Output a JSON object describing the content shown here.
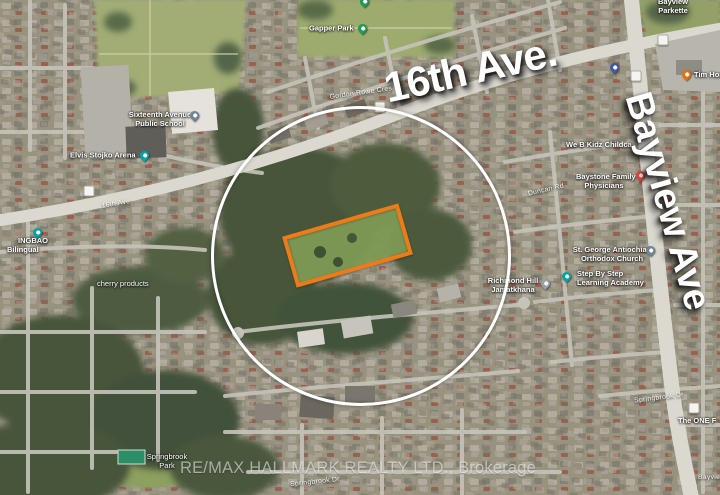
{
  "overlays": {
    "street_label_top": "16th Ave.",
    "street_label_right": "Bayview Ave",
    "watermark": "RE/MAX HALLMARK REALTY LTD., Brokerage",
    "highlight_circle_color": "#ffffff",
    "highlight_rect_color": "#ee7a18"
  },
  "places": [
    {
      "name": "gapper-park",
      "text": "Gapper Park",
      "pin_color": "#1c9c55"
    },
    {
      "name": "bayview-parkette",
      "line1": "Bayview",
      "line2": "Parkette"
    },
    {
      "name": "tim-hortons",
      "text": "Tim Horto",
      "pin_color": "#e8710a"
    },
    {
      "name": "unnamed-place",
      "pin_color": "#3d5ba9"
    },
    {
      "name": "sixteenth-avenue-public-school",
      "line1": "Sixteenth Avenue",
      "line2": "Public School",
      "pin_color": "#6f8596"
    },
    {
      "name": "elvis-stojko-arena",
      "text": "Elvis Stojko Arena",
      "pin_color": "#00a5a5"
    },
    {
      "name": "bilingual-school",
      "line1": "INGBAO",
      "line2": "Bilingual",
      "pin_color": "#00a5a5"
    },
    {
      "name": "cherry-products",
      "text": "cherry products"
    },
    {
      "name": "we-b-kidz-childcare",
      "text": "We B Kidz Childca"
    },
    {
      "name": "baystone-family-physicians",
      "line1": "Baystone Family",
      "line2": "Physicians",
      "pin_color": "#e5493d"
    },
    {
      "name": "st-george-antiochian-orthodox-church",
      "line1": "St. George Antiochian",
      "line2": "Orthodox Church",
      "pin_color": "#6f8596"
    },
    {
      "name": "richmond-hill-jamatkhana",
      "line1": "Richmond Hill",
      "line2": "Jamatkhana",
      "pin_color": "#9aa0a6"
    },
    {
      "name": "step-by-step-learning-academy",
      "line1": "Step By Step",
      "line2": "Learning Academy",
      "pin_color": "#00a5a5"
    },
    {
      "name": "springbrook-park",
      "line1": "Springbrook",
      "line2": "Park"
    },
    {
      "name": "the-one",
      "text": "The ONE F"
    }
  ],
  "streets": [
    {
      "text": "16th Ave"
    },
    {
      "text": "Gordon Rowe Cres"
    },
    {
      "text": "Duncan Rd"
    },
    {
      "text": "Springbrook Dr"
    },
    {
      "text": "Springbrook Dr"
    },
    {
      "text": "Bayview"
    }
  ]
}
